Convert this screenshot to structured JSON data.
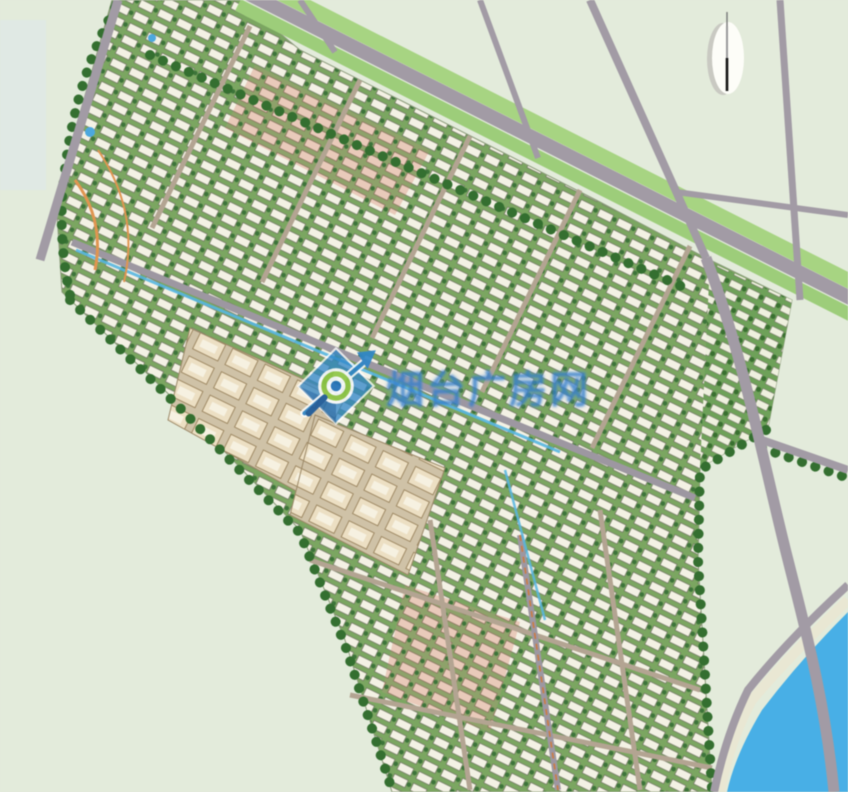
{
  "page": {
    "description": "Aerial master plan rendering of a residential development district"
  },
  "watermark": {
    "text": "烟台广房网",
    "color": "#2b78c8",
    "logo_icon": "magnifier-diamond-icon"
  },
  "compass": {
    "icon": "north-compass-icon",
    "needle_color": "#1b1b1b",
    "face_color": "#fdfdf8"
  },
  "palette": {
    "field": "#e3ebdb",
    "road": "#a29ba5",
    "internal_road": "#b3a491",
    "avenue_green_belt": "#a6d480",
    "tree_dark": "#33702f",
    "building_white": "#f3f1e4",
    "building_pink": "#e9c6b4",
    "building_tan": "#ecdfc2",
    "row_green": "#7aa65f",
    "canal_blue": "#55b7e3",
    "river_blue": "#45b0e8",
    "river_bank": "#e9e7d2",
    "park_path_orange": "#e2954e"
  }
}
